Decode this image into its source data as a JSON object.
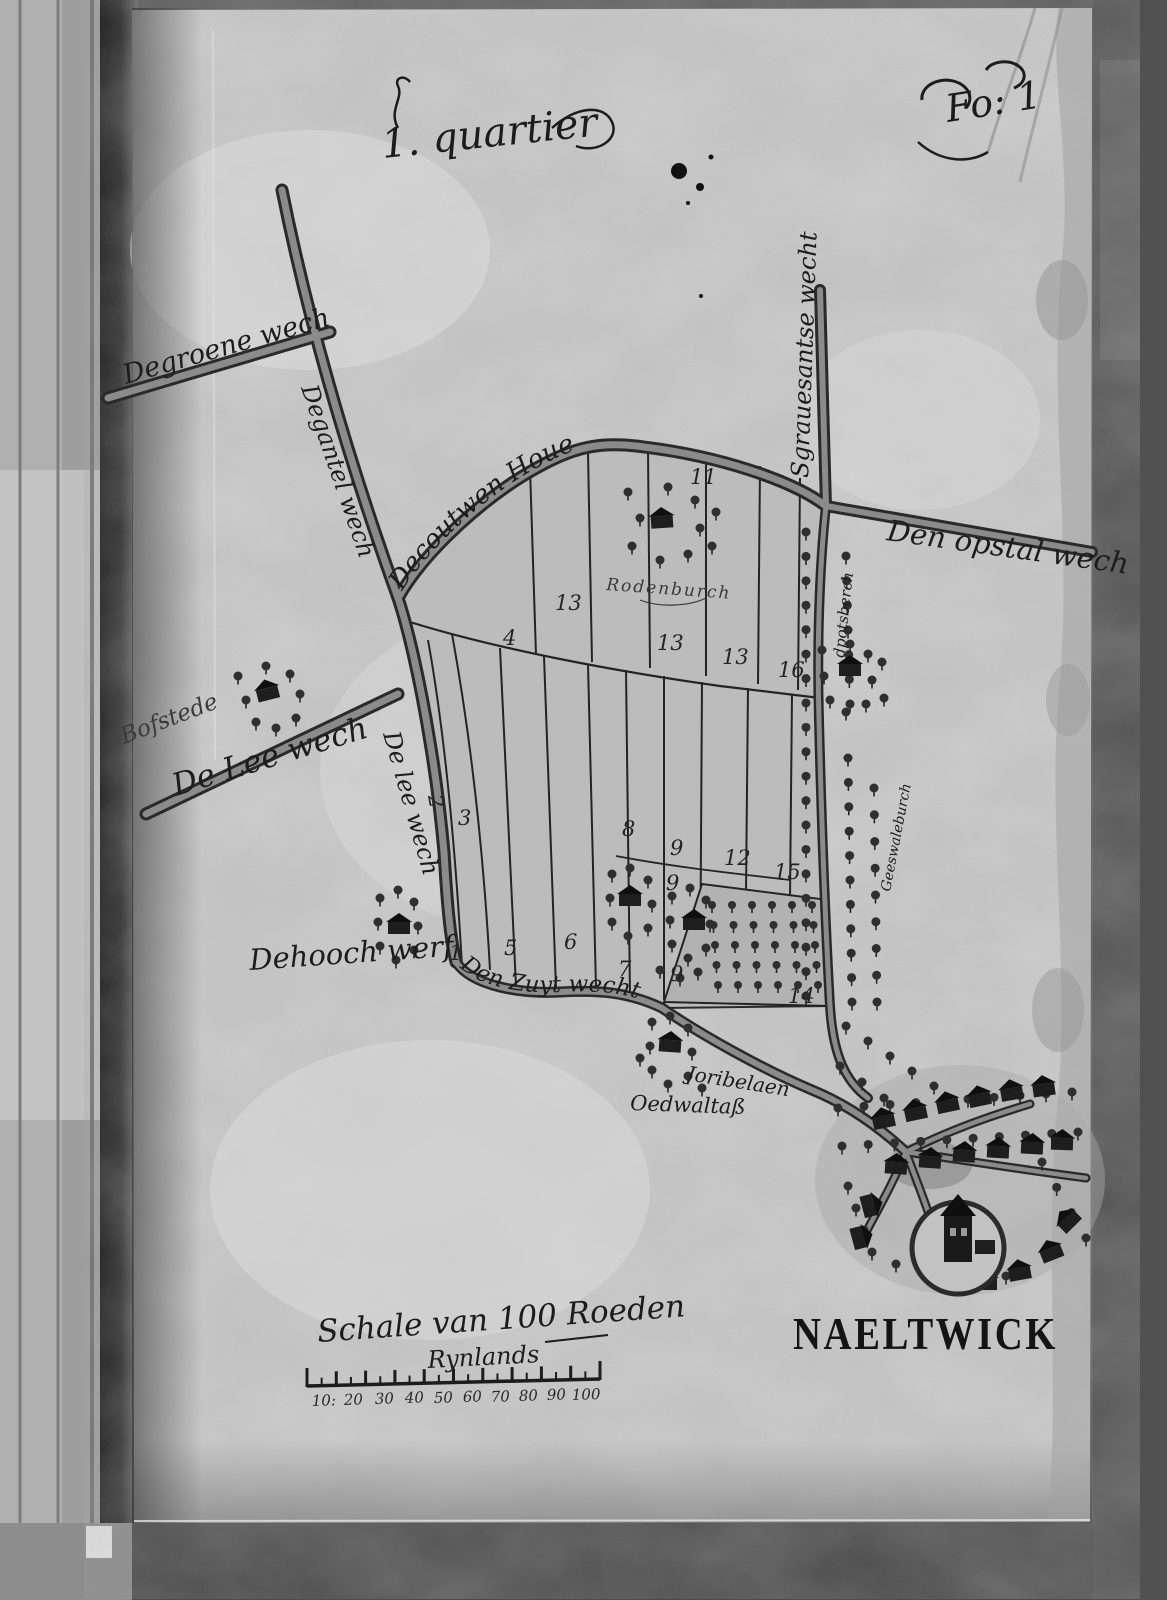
{
  "page": {
    "quarter_title": "1. quartier",
    "folio": "Fo: 1"
  },
  "labels": {
    "groene": "Degroene wech",
    "gantel": "Degantel wech",
    "lee_vertical": "De lee wech",
    "lee": "De Lee wech",
    "bofstede": "Bofstede",
    "coutwen": "Decoutwen Houe",
    "gravesant": "Sgrauesantse wecht",
    "opstal": "Den opstal wech",
    "rodenburch": "Rodenburch",
    "potsberch": "dpotsberch",
    "swaleburch": "Geeswaleburch",
    "hooch_werf": "Dehooch werf",
    "zuyt": "Den Zuyt wecht",
    "joribelaen": "Joribelaen",
    "oedwal": "Oedwaltaß",
    "town": "NAELTWICK"
  },
  "parcels": [
    {
      "n": "13"
    },
    {
      "n": "4"
    },
    {
      "n": "13"
    },
    {
      "n": "13"
    },
    {
      "n": "16"
    },
    {
      "n": "11"
    },
    {
      "n": "2"
    },
    {
      "n": "3"
    },
    {
      "n": "8"
    },
    {
      "n": "9"
    },
    {
      "n": "12"
    },
    {
      "n": "15"
    },
    {
      "n": "9"
    },
    {
      "n": "1"
    },
    {
      "n": "5"
    },
    {
      "n": "6"
    },
    {
      "n": "7"
    },
    {
      "n": "9"
    },
    {
      "n": "14"
    }
  ],
  "scale": {
    "title": "Schale van 100 Roeden",
    "subtitle": "Rynlands",
    "ticks": [
      "10:",
      "20",
      "30",
      "40",
      "50",
      "60",
      "70",
      "80",
      "90",
      "100"
    ]
  },
  "colors": {
    "ink": "#1c1c1c",
    "parchment": "#cfcfcf",
    "polder": "#bcbcbc"
  }
}
